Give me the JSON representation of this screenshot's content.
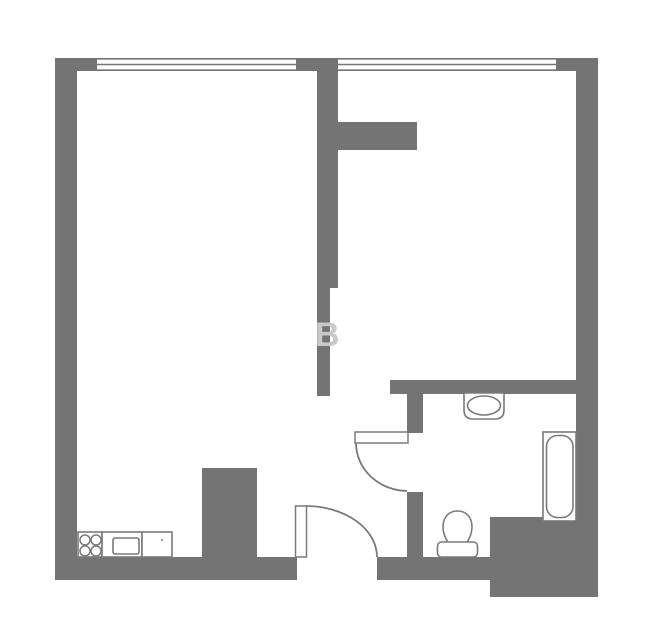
{
  "floorplan": {
    "kind": "apartment-floor-plan",
    "watermark": "B",
    "colors": {
      "wall": "#747474",
      "outline": "#7a7a7a",
      "background": "#ffffff",
      "watermark": "#c9c9c9"
    },
    "icons": [
      "stove-icon",
      "oven-icon",
      "kitchen-counter-icon",
      "sink-icon",
      "bathtub-icon",
      "toilet-icon",
      "door-swing-icon",
      "window-icon"
    ]
  }
}
